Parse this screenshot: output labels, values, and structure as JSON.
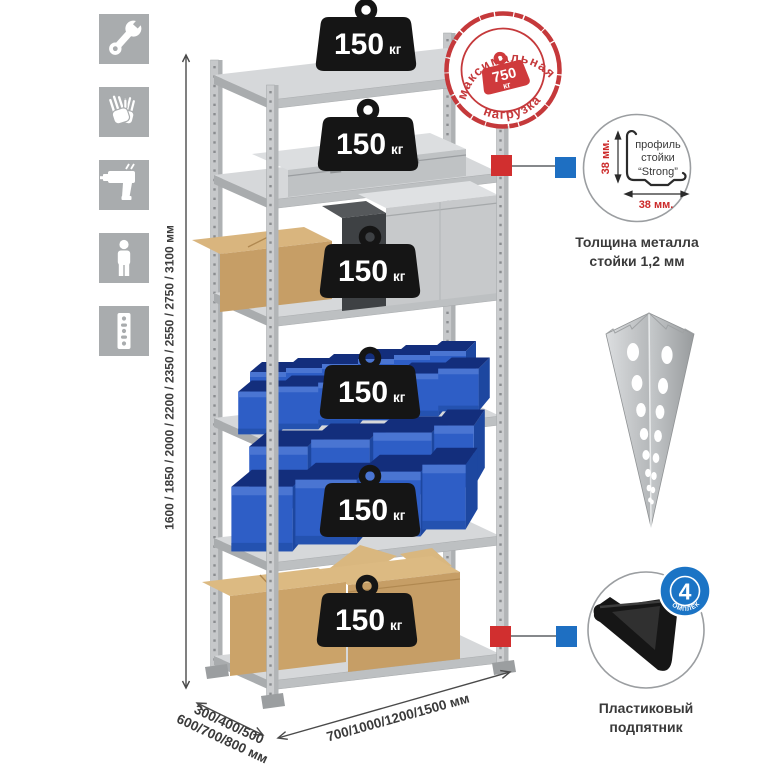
{
  "assembly_icons": {
    "tile_color": "#a9acae",
    "items": [
      {
        "icon": "wrench-icon"
      },
      {
        "icon": "gloves-icon"
      },
      {
        "icon": "drill-icon"
      },
      {
        "icon": "person-icon"
      },
      {
        "icon": "rack-post-icon"
      }
    ]
  },
  "height_dimension": {
    "label": "1600 / 1850 / 2000 / 2200 / 2350 / 2550 / 2750 / 3100 мм"
  },
  "depth_dimension": {
    "line1": "300/400/500",
    "line2": "600/700/800 мм"
  },
  "width_dimension": {
    "label": "700/1000/1200/1500 мм"
  },
  "shelving": {
    "shelf_count": 6
  },
  "shelf_load": {
    "value": "150",
    "unit": "кг"
  },
  "max_load_stamp": {
    "arc_top": "максимальная",
    "arc_bottom": "нагрузка",
    "value": "750",
    "unit": "кг",
    "color": "#c5393b"
  },
  "post_profile_detail": {
    "label_line1": "профиль",
    "label_line2": "стойки",
    "label_line3": "“Strong”",
    "height_dim": "38 мм.",
    "width_dim": "38 мм.",
    "caption_line1": "Толщина металла",
    "caption_line2": "стойки 1,2 мм",
    "dim_color": "#cc2a2a"
  },
  "foot_detail": {
    "badge_value": "4",
    "badge_arc_text": "в комплекте",
    "caption_line1": "Пластиковый",
    "caption_line2": "подпятник",
    "badge_color": "#1b74c5"
  },
  "markers": {
    "red": "#d12f2f",
    "blue": "#1e6fc2"
  }
}
